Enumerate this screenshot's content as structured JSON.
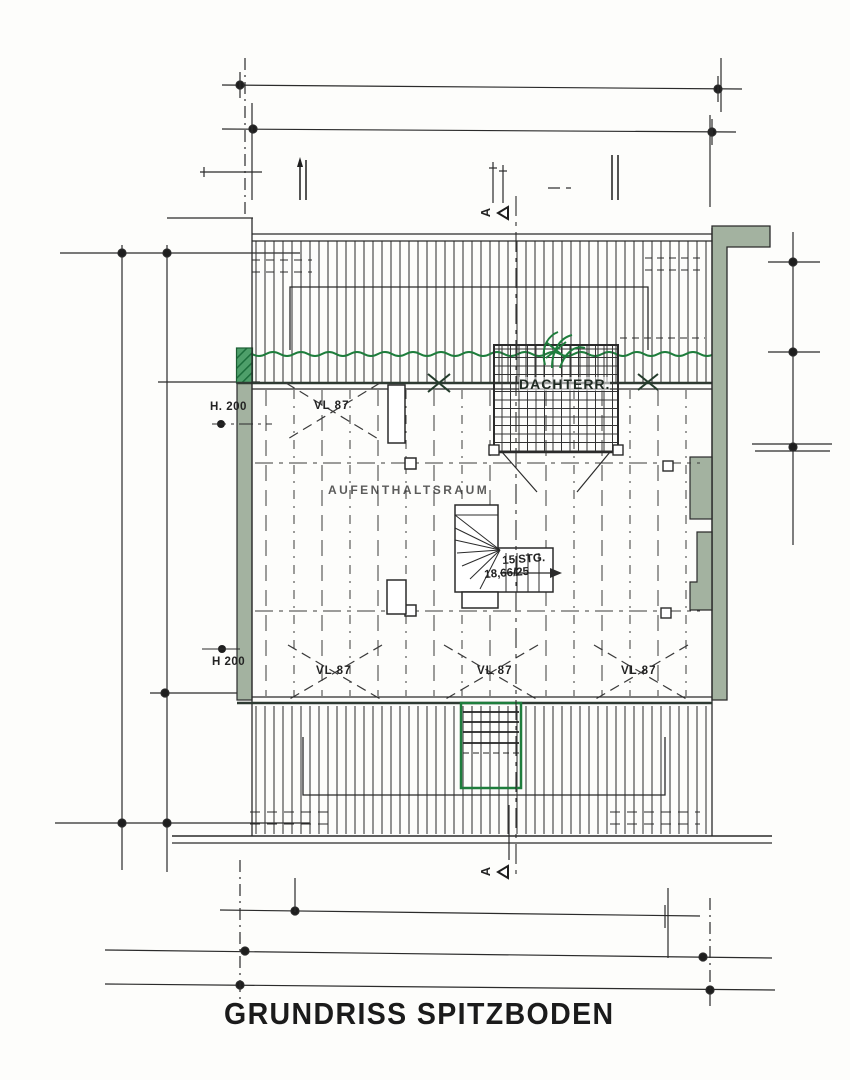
{
  "page": {
    "title": "GRUNDRISS SPITZBODEN"
  },
  "plan": {
    "room_label": "AUFENTHALTSRAUM",
    "terrace_label": "DACHTERR.",
    "stair_steps": "15 STG.",
    "stair_ratio": "18,66/25",
    "height_label_top": "H. 200",
    "height_label_bottom": "H 200",
    "joist_label": "VL 87",
    "section_marker": "A",
    "colors": {
      "ink": "#2b2b2b",
      "accent_green": "#1e7d3c",
      "wall_fill": "#a3b2a0"
    }
  }
}
